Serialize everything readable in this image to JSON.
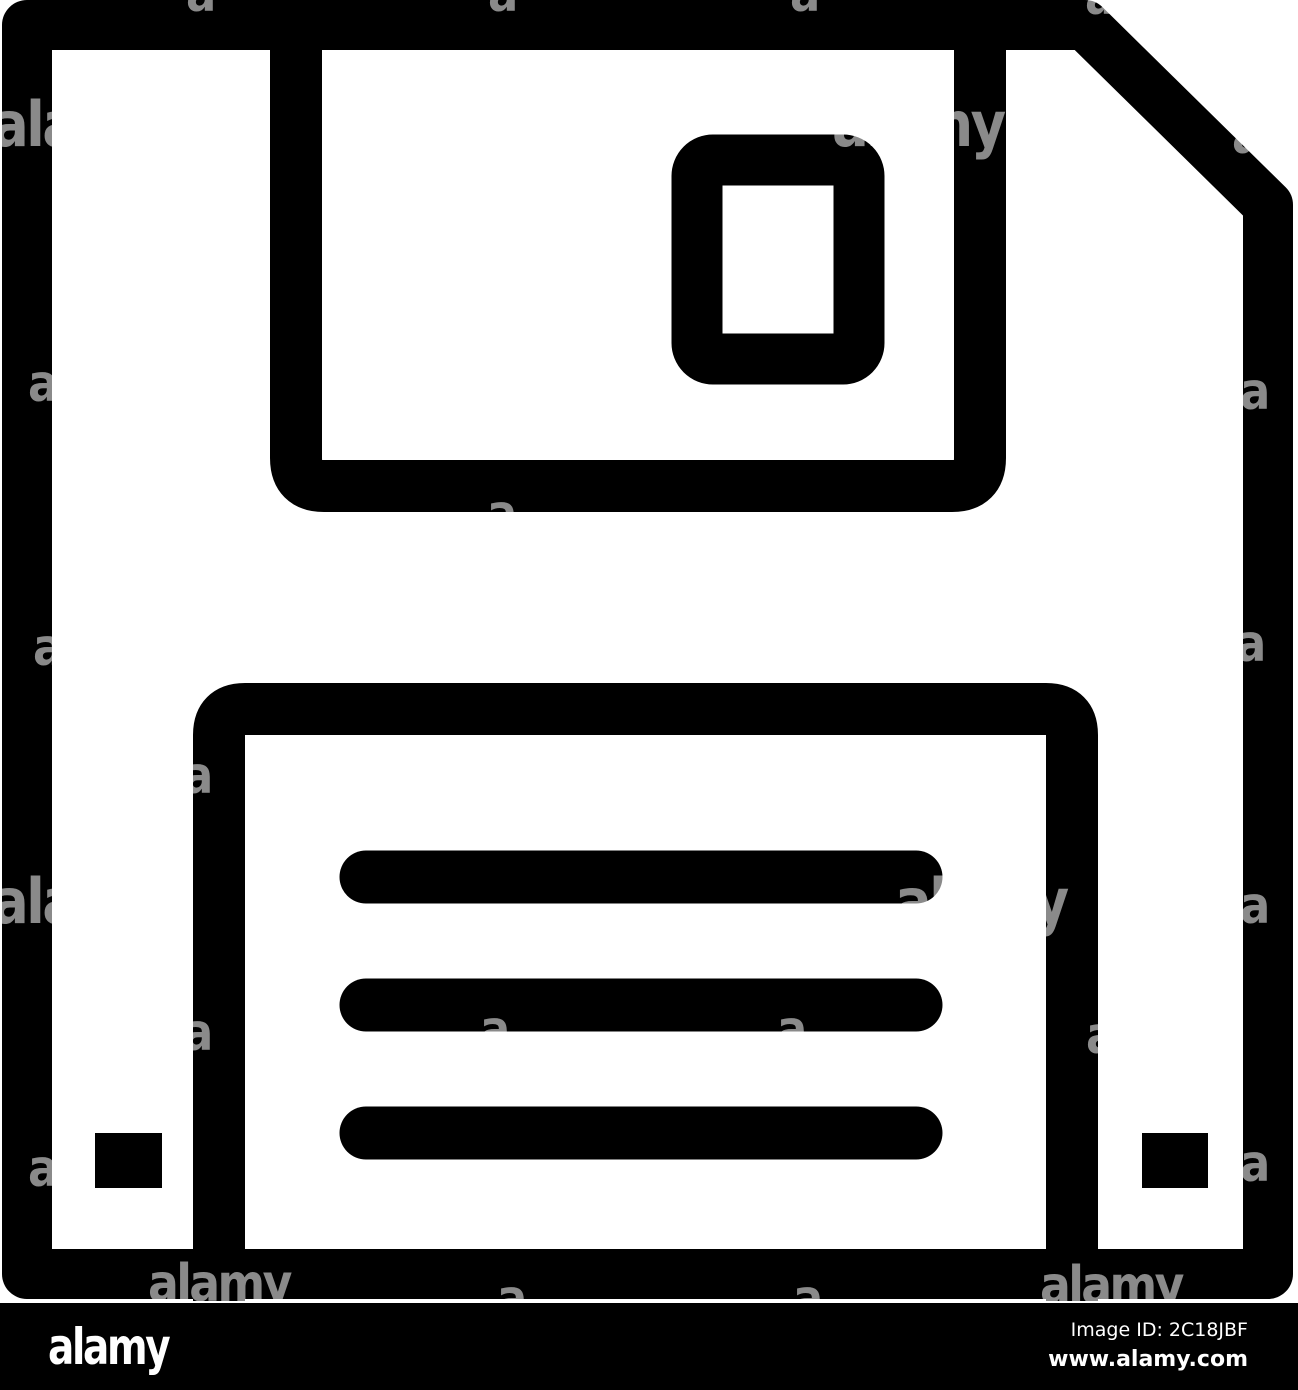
{
  "image": {
    "subject": "Floppy disk save icon, black outline pictogram on white",
    "watermark": {
      "word": "alamy",
      "letter": "a"
    },
    "colors": {
      "icon": "#000000",
      "background": "#ffffff",
      "watermark": "rgba(255,255,255,0.54)",
      "footer_bg": "#000000",
      "footer_text": "#ffffff"
    }
  },
  "footer": {
    "logo": "alamy",
    "image_id": "Image ID: 2C18JBF",
    "website": "www.alamy.com"
  }
}
